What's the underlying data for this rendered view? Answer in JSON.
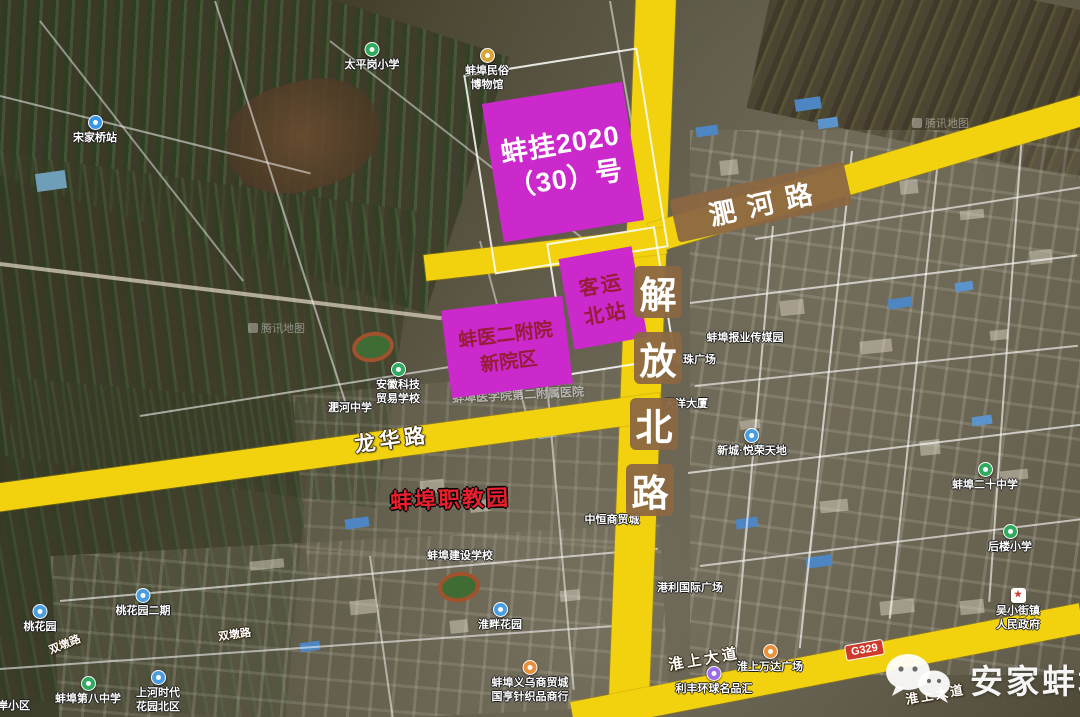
{
  "watermarks": {
    "tencent": "腾讯地图",
    "wechat_account": "安家蚌埠"
  },
  "parcel": {
    "line1": "蚌挂2020",
    "line2": "（30）号"
  },
  "station_box": {
    "line1": "客运",
    "line2": "北站"
  },
  "hospital_box": {
    "line1": "蚌医二附院",
    "line2": "新院区"
  },
  "hospital_under": "蚌埠医学院第二附属医院",
  "education_park": "蚌埠职教园",
  "roads": {
    "feihe": "淝河路",
    "jiefang": [
      "解",
      "放",
      "北",
      "路"
    ],
    "longhua": "龙华路",
    "huaishang": "淮上大道",
    "huaishang2": "淮上大道",
    "shuangdun": "双墩路",
    "shuangdun2": "双墩路",
    "g329": "G329"
  },
  "pois": [
    {
      "x": 95,
      "y": 115,
      "icon": "transit",
      "lines": [
        "宋家桥站"
      ]
    },
    {
      "x": 372,
      "y": 42,
      "icon": "school",
      "lines": [
        "太平岗小学"
      ]
    },
    {
      "x": 487,
      "y": 48,
      "icon": "museum",
      "lines": [
        "蚌埠民俗",
        "博物馆"
      ]
    },
    {
      "x": 745,
      "y": 332,
      "icon": "none",
      "lines": [
        "蚌埠报业传媒园"
      ]
    },
    {
      "x": 694,
      "y": 354,
      "icon": "none",
      "lines": [
        "锦珠广场"
      ]
    },
    {
      "x": 686,
      "y": 398,
      "icon": "none",
      "lines": [
        "天洋大厦"
      ]
    },
    {
      "x": 752,
      "y": 428,
      "icon": "residential",
      "lines": [
        "新城·悦荣天地"
      ]
    },
    {
      "x": 985,
      "y": 462,
      "icon": "school",
      "lines": [
        "蚌埠二十中学"
      ]
    },
    {
      "x": 1010,
      "y": 524,
      "icon": "school",
      "lines": [
        "后楼小学"
      ]
    },
    {
      "x": 1018,
      "y": 588,
      "icon": "government",
      "lines": [
        "吴小街镇",
        "人民政府"
      ]
    },
    {
      "x": 398,
      "y": 362,
      "icon": "school",
      "lines": [
        "安徽科技",
        "贸易学校"
      ]
    },
    {
      "x": 350,
      "y": 402,
      "icon": "none",
      "lines": [
        "淝河中学"
      ]
    },
    {
      "x": 612,
      "y": 514,
      "icon": "none",
      "lines": [
        "中恒商贸城"
      ]
    },
    {
      "x": 460,
      "y": 550,
      "icon": "none",
      "lines": [
        "蚌埠建设学校"
      ]
    },
    {
      "x": 500,
      "y": 602,
      "icon": "residential",
      "lines": [
        "淮畔花园"
      ]
    },
    {
      "x": 530,
      "y": 660,
      "icon": "shopping",
      "lines": [
        "蚌埠义乌商贸城",
        "国亨针织品商行"
      ]
    },
    {
      "x": 770,
      "y": 644,
      "icon": "shopping",
      "lines": [
        "淮上万达广场"
      ]
    },
    {
      "x": 714,
      "y": 666,
      "icon": "shopping-purple",
      "lines": [
        "利丰环球名品汇"
      ]
    },
    {
      "x": 690,
      "y": 582,
      "icon": "none",
      "lines": [
        "港利国际广场"
      ]
    },
    {
      "x": 40,
      "y": 604,
      "icon": "residential",
      "lines": [
        "桃花园"
      ]
    },
    {
      "x": 143,
      "y": 588,
      "icon": "residential",
      "lines": [
        "桃花园二期"
      ]
    },
    {
      "x": 88,
      "y": 676,
      "icon": "school",
      "lines": [
        "蚌埠第八中学"
      ]
    },
    {
      "x": 158,
      "y": 670,
      "icon": "residential",
      "lines": [
        "上河时代",
        "花园北区"
      ]
    },
    {
      "x": 8,
      "y": 700,
      "icon": "none",
      "lines": [
        "北岸小区"
      ]
    }
  ],
  "colors": {
    "annotation_magenta": "#cb29cb",
    "road_yellow": "#f2d20f",
    "plate_brown": "#8b6742",
    "parcel_text": "#ffffff",
    "box_text_darkred": "#971c38",
    "education_park_red": "#e8202e",
    "g329_red": "#cf3a2b"
  }
}
